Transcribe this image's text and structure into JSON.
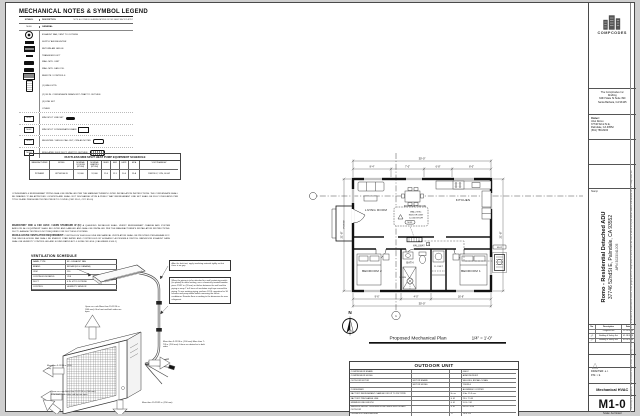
{
  "legend": {
    "title": "MECHANICAL NOTES & SYMBOL LEGEND",
    "col_symbol": "SYMBOL",
    "col_desc": "DESCRIPTION",
    "note": "NOTE: ALL SYMBOLS & ABBREVIATIONS ON THIS SHEET MAY NOT APPLY",
    "section_code": "M-00",
    "section_label": "GENERAL",
    "symbol_rows": [
      {
        "icon": "fan",
        "label": "EXHAUST FAN, VENT TO OUTSIDE"
      },
      {
        "icon": "bar-solid",
        "label": "SUPPLY AIR REGISTER"
      },
      {
        "icon": "bar-split",
        "label": "RETURN AIR GRILLE"
      },
      {
        "icon": "bar-small",
        "label": "TRANSFER DUCT"
      },
      {
        "icon": "unit-solid",
        "label": "WALL MTD. UNIT"
      },
      {
        "icon": "unit-solid",
        "label": "WALL MTD. FAN COIL"
      },
      {
        "icon": "unit-grille",
        "label": "REMOTE / CONTROLS"
      },
      {
        "icon": "remote",
        "label": "(1)  WALL MTD."
      },
      {
        "icon": "none",
        "label": "(2)  3/4 IN. CONDENSATE DRAIN W/ P-TRAP TO OUTSIDE"
      },
      {
        "icon": "none",
        "label": "(3)  LINE SET"
      },
      {
        "icon": "none",
        "label": "OTHER"
      }
    ],
    "code_rows": [
      {
        "code": "M-01",
        "label": "MINI SPLIT LINE SET",
        "tag": "solid"
      },
      {
        "code": "M-02",
        "label": "MINI SPLIT CONDENSATE DRAIN",
        "tag": "outline"
      },
      {
        "code": "M-03",
        "label": "REGISTER / GRILLE CALLOUT, CFM AS NOTED",
        "tag": "rounded"
      },
      {
        "code": "M-04",
        "label": "INSULATED FLEX DUCT, VENT TO OUTSIDE",
        "tag": "flex"
      }
    ]
  },
  "equipment_schedule": {
    "title": "DUCTLESS MINI SPLIT HEAT PUMP EQUIPMENT SCHEDULE",
    "headers": [
      "MANUFACTURER",
      "MODEL",
      "NOMINAL COOLING (BTU/H)",
      "NOMINAL HEATING (BTU/H)",
      "SEER",
      "EER",
      "HSPF",
      "MCA",
      "VOLT/PHASE/HZ"
    ],
    "row": [
      "PIONEER",
      "WYS012A-19",
      "12,000",
      "12,000",
      "19.0",
      "11.5",
      "10.0",
      "15 A",
      "208/230 V, 1 PH, 60 HZ"
    ]
  },
  "notes": {
    "para1": "CONDENSATE & REFRIGERANT PIPING SHALL BE INSTALLED PER THE MANUFACTURER'S LISTED INSTALLATION INSTRUCTIONS. THE CONDENSATE SHALL BE DRAINED TO AN APPROVED LOCATION AND SHALL NOT DISCHARGE UPON A PUBLIC WAY. REFRIGERANT LINE SET SHALL BE FULLY INSULATED PER TITLE 24 AND PRESSURE TESTED PRIOR TO COVER. (CMC 310.1, CPC 814.0)",
    "para2_head": "MANDATORY CMC & CEC HVAC / HERS STANDARD W (E):",
    "para2": "A QUALIFIED INSTALLER SHALL VERIFY REFRIGERANT CHARGE AND SYSTEM AIRFLOW. ALL EQUIPMENT SHALL BE LISTED AND LABELED AND SHALL BE INSTALLED PER THE MANUFACTURER'S INSTALLATION INSTRUCTIONS. DUCT LEAKAGE TESTING IS NOT REQUIRED FOR DUCTLESS SYSTEMS.",
    "para3_head": "WHOLE-HOUSE VENTILATION REQUIREMENT:",
    "para3": "CONTINUOUS WHOLE-HOUSE MECHANICAL VENTILATION SHALL BE PROVIDED PER ASHRAE 62.2. THE WHOLE-HOUSE FAN SHALL BE ENERGY STAR RATED AND CONTROLLED BY A READILY ACCESSIBLE SWITCH. BATHROOM EXHAUST FANS SHALL BE HUMIDITY CONTROLLED AND SOUND RATED AT 1.0 SONE OR LESS. (CALGREEN 4.506.1)"
  },
  "ventilation_schedule": {
    "title": "VENTILATION SCHEDULE",
    "rows": [
      [
        "NAME, TYPE",
        "EF - EXHAUST FAN"
      ],
      [
        "BRAND",
        "BROAN (US & CANADA)"
      ],
      [
        "CFM",
        "110"
      ],
      [
        "CONTINUOUS RATED",
        "YES"
      ],
      [
        "DUCT",
        "4 IN. Ø TO OUTSIDE"
      ],
      [
        "CONTROL",
        "HUMIDITY SENSOR"
      ]
    ]
  },
  "install_notes": {
    "note1": "After the leak test, apply insulating material tightly so that there is no gap.",
    "note2": "When the piping is to be attached to a wall containing metals (tin plated) or metal netting, use a chemically treated wooden piece 25/32 in. (20 mm) or thicker between the wall and the piping or wrap 7 to 8 turns of insulation vinyl tape around the piping. To use existing piping, perform COOL operation for 30 minutes and pump down before removing the old air conditioner. Remake flare according to the dimension for new refrigerant."
  },
  "clearances": {
    "c1": "Open as a rule More than 19-11/16 in. (500 mm) if the front and both sides are open",
    "c2": "More than 3-15/16 in. (100 mm)",
    "c3": "Open as a rule More than 19-11/16 in. (500 mm) if the back, both sides and top are open",
    "c4": "More than 3-15/16 in. (100 mm) More than 7-7/8 in. (200 mm) if there are obstacles to both sides",
    "c5": "More than 19-29/32 in. (350 mm)"
  },
  "floor_plan": {
    "caption": "Proposed Mechanical Plan",
    "scale": "1/4\" = 1'-0\"",
    "north": "N",
    "bubble": "1",
    "rooms": [
      "LIVING ROOM",
      "DINING NOOK",
      "KITCHEN",
      "HALLWAY",
      "BATH",
      "CLOSET",
      "BEDROOM 2",
      "BEDROOM 1",
      "PORCH"
    ],
    "callout": {
      "l1": "WALL MTD.",
      "l2": "INDOOR UNIT",
      "l3": "12,000 BTU/H",
      "tag": "M-01"
    },
    "condenser_tag": "M-02",
    "fan_label": "50 CFM",
    "thermostat": "T",
    "dims": {
      "top_total": "30'-0\"",
      "top": [
        "8'-4\"",
        "7'-0\"",
        "6'-8\"",
        "8'-0\""
      ],
      "left_total": "21'-8\"",
      "right_total": "21'-8\"",
      "bottom": [
        "9'-6\"",
        "4'-0\"",
        "16'-6\""
      ],
      "bottom_total": "30'-0\""
    }
  },
  "outdoor_unit_table": {
    "title": "OUTDOOR UNIT",
    "rows": [
      [
        "COMPRESSOR BRAND",
        "",
        "",
        "GMCC"
      ],
      [
        "COMPRESSOR MODEL",
        "",
        "",
        "ASM135D23UFZ"
      ],
      [
        "OUTDOOR MOTOR",
        "MOTOR BRAND",
        "",
        "WELLING, BROAD-OCEAN"
      ],
      [
        "",
        "MOTOR MODEL",
        "",
        "YDK35-6"
      ],
      [
        "CONDENSER",
        "",
        "",
        "ALUMINUM / COPPER"
      ],
      [
        "FACTORY REFRIGERANT CHARGE FOR UP TO 25FT PIPE",
        "",
        "lb. oz.",
        "4 lbs. 15.9 ozs."
      ],
      [
        "FACTORY PRECHARGE LINE",
        "",
        "ft. M",
        "25 ft. 7.5 M"
      ],
      [
        "MINIMUM LINE LENGTH",
        "",
        "ft. M",
        "9.8 ft. 3 M"
      ],
      [
        "MAXIMUM HEIGHT DIFFERENCE BETWEEN INDOOR AND OUTDOOR",
        "",
        "ft. M",
        "65.6 ft. 20 M"
      ],
      [
        "OPERATION TEMPERATURE",
        "",
        "°F",
        "14 to 115"
      ],
      [
        "ROOM TEMPERATURE",
        "INDOOR (COOLING / HEATING)",
        "°F",
        "62 to 90 / 60 to 86"
      ],
      [
        "",
        "OUTDOOR (COOLING / HEATING)",
        "°F",
        "5 to 115 / -13 to 75"
      ]
    ]
  },
  "title_block": {
    "logo_text": "COMPCODES",
    "firm_lines": [
      "The CompCodes Inc",
      "Drafting",
      "3463 State St Suite 390",
      "Santa Barbara, CA 93105"
    ],
    "owner_label": "Owner:",
    "owner_lines": [
      "Uriel Romo",
      "37746 52nd St E,",
      "Palmdale, CA 93552",
      "(661) 789-8200"
    ],
    "stamp_label": "Stamp",
    "project_line1": "Romo - Residential Detached ADU",
    "project_line2": "37746 52ndSt E, Palmdale, CA 93552",
    "project_apn": "APN 3023041005",
    "rev_headers": [
      "No.",
      "Description",
      "Date"
    ],
    "revisions": [
      {
        "no": "",
        "desc": "Progress Set",
        "date": "12.19.2023"
      },
      {
        "no": "1",
        "desc": "Building & Safety Set",
        "date": "01.18.2024"
      },
      {
        "no": "2",
        "desc": "Building & Safety Set",
        "date": "02.06.2024"
      }
    ],
    "drafter": "DRAFTER:  e.r.",
    "pm": "P.M.:  r.k.",
    "discipline": "Mechanical HVAC",
    "sheet_number": "M1-0",
    "scale_note": "Scale: As Noted",
    "fine_print": "Ownership of Documents: This document and the ideas and design incorporated herein, as an instrument of professional service, is the property of The CompCodes Inc and is not to be used in whole or in part without written authorization of The CompCodes Inc."
  }
}
